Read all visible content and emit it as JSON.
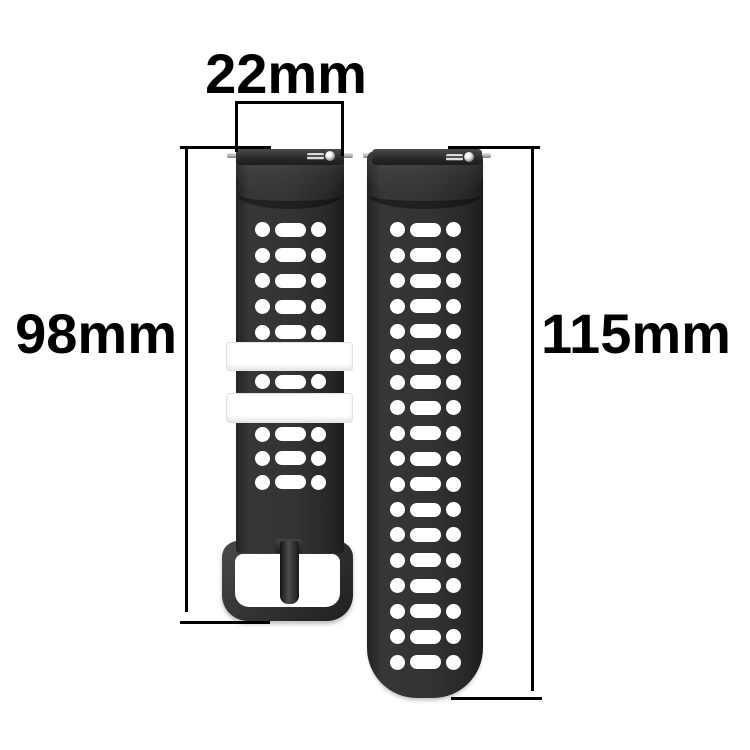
{
  "diagram": {
    "dim_width": {
      "label": "22mm"
    },
    "dim_left_length": {
      "label": "98mm"
    },
    "dim_right_length": {
      "label": "115mm"
    }
  },
  "straps": {
    "left": {
      "name": "buckle-side strap",
      "hole_rows_top": 5,
      "hole_rows_mid": 1,
      "hole_rows_bottom": 3,
      "keeper_count": 2
    },
    "right": {
      "name": "tail-side strap",
      "hole_rows": 18
    }
  },
  "colors": {
    "strap_dark": "#2e2e2e",
    "strap_edge": "#1c1c1c",
    "keeper_white": "#ffffff",
    "buckle_gray": "#343434",
    "pin_silver": "#b5b5b5",
    "annotation_black": "#000000",
    "background": "#ffffff"
  }
}
